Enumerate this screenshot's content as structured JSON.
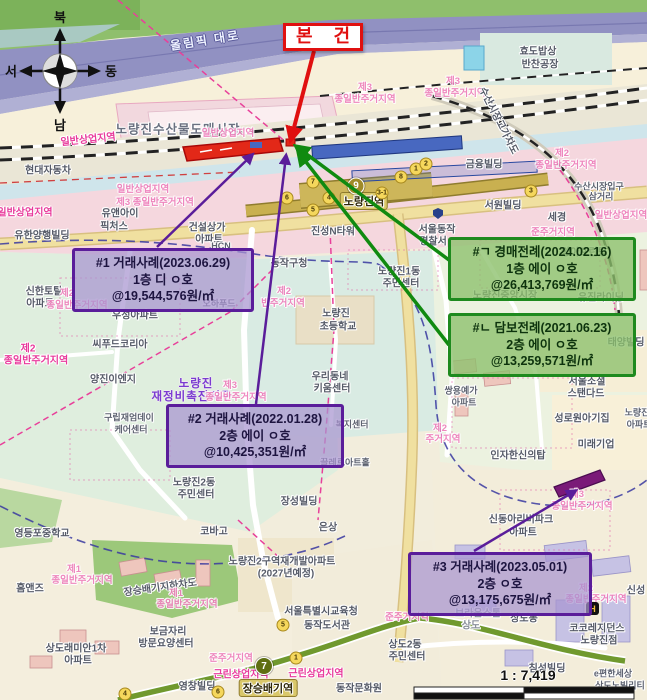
{
  "subject": {
    "label": "본 건"
  },
  "compass": {
    "north": "북",
    "south": "남",
    "east": "동",
    "west": "서"
  },
  "scale": {
    "ratio_text": "1 : 7,419"
  },
  "subway": {
    "line9": {
      "number": "9",
      "station": "노량진역"
    },
    "line7": {
      "number": "7",
      "station": "장승배기역"
    },
    "exits": [
      {
        "n": "6",
        "x": 287,
        "y": 198
      },
      {
        "n": "5",
        "x": 313,
        "y": 210
      },
      {
        "n": "7",
        "x": 313,
        "y": 182
      },
      {
        "n": "4",
        "x": 329,
        "y": 198
      },
      {
        "n": "3-1",
        "x": 382,
        "y": 193
      },
      {
        "n": "8",
        "x": 401,
        "y": 177
      },
      {
        "n": "1",
        "x": 416,
        "y": 169
      },
      {
        "n": "2",
        "x": 426,
        "y": 164
      },
      {
        "n": "3",
        "x": 531,
        "y": 191
      },
      {
        "n": "5",
        "x": 283,
        "y": 625
      },
      {
        "n": "1",
        "x": 296,
        "y": 658
      },
      {
        "n": "6",
        "x": 218,
        "y": 692
      },
      {
        "n": "4",
        "x": 125,
        "y": 694
      }
    ]
  },
  "colors": {
    "transaction_border": "#5a1d9a",
    "precedent_border": "#1e8a1e",
    "subject_red": "#e01010",
    "line9_gold": "#a08a28",
    "line7_olive": "#5f6f12"
  },
  "annotations": {
    "boxes": [
      {
        "type": "transaction",
        "line1": "#1 거래사례(2023.06.29)",
        "line2": "1층 디 ㅇ호",
        "line3": "@19,544,576원/㎡"
      },
      {
        "type": "transaction",
        "line1": "#2 거래사례(2022.01.28)",
        "line2": "2층 에이 ㅇ호",
        "line3": "@10,425,351원/㎡"
      },
      {
        "type": "transaction",
        "line1": "#3 거래사례(2023.05.01)",
        "line2": "2층 ㅇ호",
        "line3": "@13,175,675원/㎡"
      },
      {
        "type": "auction",
        "line1": "#ㄱ 경매전례(2024.02.16)",
        "line2": "1층 에이 ㅇ호",
        "line3": "@26,413,769원/㎡"
      },
      {
        "type": "mortgage",
        "line1": "#ㄴ 담보전례(2021.06.23)",
        "line2": "2층 에이 ㅇ호",
        "line3": "@13,259,571원/㎡"
      }
    ]
  },
  "hotel_icon_label": "H",
  "map_labels": [
    {
      "t": "올림픽 대로",
      "x": 205,
      "y": 40,
      "c": "road",
      "r": -9
    },
    {
      "t": "효도밥상",
      "x": 538,
      "y": 50,
      "c": "g"
    },
    {
      "t": "반찬공장",
      "x": 540,
      "y": 63,
      "c": "g"
    },
    {
      "t": "노량진수산물도매시장",
      "x": 178,
      "y": 128,
      "c": "gbig"
    },
    {
      "t": "일반상업지역",
      "x": 88,
      "y": 138,
      "c": "pink",
      "r": -6
    },
    {
      "t": "일반상업지역",
      "x": 228,
      "y": 132,
      "c": "pinkf"
    },
    {
      "t": "제3",
      "x": 365,
      "y": 86,
      "c": "pinkf"
    },
    {
      "t": "종일반주거지역",
      "x": 365,
      "y": 98,
      "c": "pinkf"
    },
    {
      "t": "제3",
      "x": 453,
      "y": 80,
      "c": "pinkf"
    },
    {
      "t": "종일반주거지역",
      "x": 455,
      "y": 92,
      "c": "pinkf"
    },
    {
      "t": "수산시장고가차도",
      "x": 500,
      "y": 120,
      "c": "g",
      "r": 63
    },
    {
      "t": "금융빌딩",
      "x": 484,
      "y": 163,
      "c": "g"
    },
    {
      "t": "제2",
      "x": 562,
      "y": 152,
      "c": "pinkf"
    },
    {
      "t": "종일반주거지역",
      "x": 566,
      "y": 164,
      "c": "pinkf"
    },
    {
      "t": "현대자동차",
      "x": 48,
      "y": 169,
      "c": "g"
    },
    {
      "t": "일반상업지역",
      "x": 25,
      "y": 211,
      "c": "pink"
    },
    {
      "t": "일반상업지역",
      "x": 143,
      "y": 188,
      "c": "pinkf"
    },
    {
      "t": "제3 종일반주거지역",
      "x": 155,
      "y": 201,
      "c": "pinkf"
    },
    {
      "t": "유앤아이",
      "x": 120,
      "y": 212,
      "c": "g"
    },
    {
      "t": "픽처스",
      "x": 114,
      "y": 225,
      "c": "g"
    },
    {
      "t": "건설상가",
      "x": 207,
      "y": 226,
      "c": "g"
    },
    {
      "t": "아파트",
      "x": 209,
      "y": 238,
      "c": "g"
    },
    {
      "t": "유한양행빌딩",
      "x": 42,
      "y": 234,
      "c": "g"
    },
    {
      "t": "HCN",
      "x": 221,
      "y": 246,
      "c": "gsm"
    },
    {
      "t": "수산시장입구",
      "x": 599,
      "y": 186,
      "c": "gsm"
    },
    {
      "t": "삼거리",
      "x": 601,
      "y": 196,
      "c": "gsm"
    },
    {
      "t": "일반상업지역",
      "x": 621,
      "y": 214,
      "c": "pinkf"
    },
    {
      "t": "서원빌딩",
      "x": 503,
      "y": 204,
      "c": "g"
    },
    {
      "t": "세경",
      "x": 557,
      "y": 216,
      "c": "g"
    },
    {
      "t": "노량진역",
      "x": 364,
      "y": 201,
      "c": "st"
    },
    {
      "t": "진성N타워",
      "x": 333,
      "y": 230,
      "c": "g"
    },
    {
      "t": "서울동작",
      "x": 437,
      "y": 228,
      "c": "g"
    },
    {
      "t": "경찰서",
      "x": 433,
      "y": 240,
      "c": "g"
    },
    {
      "t": "동작구청",
      "x": 289,
      "y": 262,
      "c": "g"
    },
    {
      "t": "노량진1동",
      "x": 399,
      "y": 270,
      "c": "g"
    },
    {
      "t": "주민센터",
      "x": 401,
      "y": 282,
      "c": "g"
    },
    {
      "t": "노량진",
      "x": 336,
      "y": 312,
      "c": "g"
    },
    {
      "t": "초등학교",
      "x": 338,
      "y": 325,
      "c": "g"
    },
    {
      "t": "제2",
      "x": 284,
      "y": 290,
      "c": "pinkf"
    },
    {
      "t": "반주거지역",
      "x": 283,
      "y": 302,
      "c": "pinkf"
    },
    {
      "t": "준주거지역",
      "x": 553,
      "y": 231,
      "c": "pinkf"
    },
    {
      "t": "양아프린팅",
      "x": 584,
      "y": 251,
      "c": "g"
    },
    {
      "t": "노량진중앙시장",
      "x": 505,
      "y": 294,
      "c": "g"
    },
    {
      "t": "유진라이닝",
      "x": 601,
      "y": 296,
      "c": "g"
    },
    {
      "t": "태양빌딩",
      "x": 626,
      "y": 341,
      "c": "g"
    },
    {
      "t": "서울소셜",
      "x": 587,
      "y": 380,
      "c": "g"
    },
    {
      "t": "스탠다드",
      "x": 586,
      "y": 392,
      "c": "g"
    },
    {
      "t": "성로원아기집",
      "x": 582,
      "y": 417,
      "c": "g"
    },
    {
      "t": "미래기업",
      "x": 596,
      "y": 443,
      "c": "g"
    },
    {
      "t": "인자한신의탑",
      "x": 518,
      "y": 454,
      "c": "g"
    },
    {
      "t": "쌍용예가",
      "x": 461,
      "y": 390,
      "c": "gsm"
    },
    {
      "t": "아파트",
      "x": 464,
      "y": 402,
      "c": "gsm"
    },
    {
      "t": "제2",
      "x": 440,
      "y": 427,
      "c": "pinkf"
    },
    {
      "t": "주거지역",
      "x": 443,
      "y": 438,
      "c": "pinkf"
    },
    {
      "t": "노량진",
      "x": 637,
      "y": 412,
      "c": "gsm"
    },
    {
      "t": "아파트",
      "x": 639,
      "y": 424,
      "c": "gsm"
    },
    {
      "t": "우리동네",
      "x": 330,
      "y": 375,
      "c": "g"
    },
    {
      "t": "키움센터",
      "x": 332,
      "y": 387,
      "c": "g"
    },
    {
      "t": "복지센터",
      "x": 352,
      "y": 424,
      "c": "gsm"
    },
    {
      "t": "끌레르아트홀",
      "x": 345,
      "y": 462,
      "c": "gsm"
    },
    {
      "t": "노량진",
      "x": 196,
      "y": 383,
      "c": "ppl"
    },
    {
      "t": "재정비촉진지구",
      "x": 192,
      "y": 396,
      "c": "ppl"
    },
    {
      "t": "제3",
      "x": 230,
      "y": 384,
      "c": "pinkf"
    },
    {
      "t": "종일반주거지역",
      "x": 236,
      "y": 396,
      "c": "pinkf"
    },
    {
      "t": "신한토탈",
      "x": 44,
      "y": 290,
      "c": "g"
    },
    {
      "t": "아파트",
      "x": 40,
      "y": 302,
      "c": "g"
    },
    {
      "t": "제2",
      "x": 67,
      "y": 292,
      "c": "pinkf"
    },
    {
      "t": "종일반주거지역",
      "x": 77,
      "y": 304,
      "c": "pinkf"
    },
    {
      "t": "제2",
      "x": 28,
      "y": 347,
      "c": "pink"
    },
    {
      "t": "종일반주거지역",
      "x": 36,
      "y": 359,
      "c": "pink"
    },
    {
      "t": "우성아파트",
      "x": 135,
      "y": 314,
      "c": "g"
    },
    {
      "t": "오하푸드",
      "x": 219,
      "y": 303,
      "c": "gsm"
    },
    {
      "t": "씨푸드코리아",
      "x": 120,
      "y": 343,
      "c": "g"
    },
    {
      "t": "양진이엔지",
      "x": 113,
      "y": 378,
      "c": "g"
    },
    {
      "t": "구립재엄데이",
      "x": 129,
      "y": 417,
      "c": "gsm"
    },
    {
      "t": "케어센터",
      "x": 131,
      "y": 429,
      "c": "gsm"
    },
    {
      "t": "노량진2동",
      "x": 194,
      "y": 481,
      "c": "g"
    },
    {
      "t": "주민센터",
      "x": 196,
      "y": 493,
      "c": "g"
    },
    {
      "t": "장성빌딩",
      "x": 299,
      "y": 500,
      "c": "g"
    },
    {
      "t": "코바고",
      "x": 214,
      "y": 530,
      "c": "g"
    },
    {
      "t": "은상",
      "x": 328,
      "y": 526,
      "c": "g"
    },
    {
      "t": "영등포중학교",
      "x": 42,
      "y": 532,
      "c": "g"
    },
    {
      "t": "홈앤즈",
      "x": 30,
      "y": 587,
      "c": "g"
    },
    {
      "t": "노량진2구역재개발아파트",
      "x": 282,
      "y": 560,
      "c": "g"
    },
    {
      "t": "(2027년예정)",
      "x": 286,
      "y": 572,
      "c": "g"
    },
    {
      "t": "장승배기지하차도",
      "x": 160,
      "y": 586,
      "c": "g",
      "r": -8
    },
    {
      "t": "제1",
      "x": 74,
      "y": 568,
      "c": "pinkf"
    },
    {
      "t": "종일반주거지역",
      "x": 82,
      "y": 579,
      "c": "pinkf"
    },
    {
      "t": "제1",
      "x": 176,
      "y": 592,
      "c": "pinkf"
    },
    {
      "t": "종일반주거지역",
      "x": 187,
      "y": 603,
      "c": "pinkf"
    },
    {
      "t": "보금자리",
      "x": 168,
      "y": 630,
      "c": "g"
    },
    {
      "t": "방문요양센터",
      "x": 166,
      "y": 642,
      "c": "g"
    },
    {
      "t": "상도래미안1차",
      "x": 76,
      "y": 647,
      "c": "g"
    },
    {
      "t": "아파트",
      "x": 78,
      "y": 659,
      "c": "g"
    },
    {
      "t": "준주거지역",
      "x": 231,
      "y": 657,
      "c": "pinkf"
    },
    {
      "t": "근린상업지역",
      "x": 241,
      "y": 673,
      "c": "pink"
    },
    {
      "t": "근린상업지역",
      "x": 316,
      "y": 672,
      "c": "pink"
    },
    {
      "t": "영창빌딩",
      "x": 197,
      "y": 685,
      "c": "g"
    },
    {
      "t": "장승배기역",
      "x": 268,
      "y": 688,
      "c": "st"
    },
    {
      "t": "서울특별시교육청",
      "x": 321,
      "y": 610,
      "c": "g"
    },
    {
      "t": "동작도서관",
      "x": 327,
      "y": 624,
      "c": "g"
    },
    {
      "t": "준주거지역",
      "x": 407,
      "y": 616,
      "c": "pinkf"
    },
    {
      "t": "동작문화원",
      "x": 359,
      "y": 687,
      "c": "g"
    },
    {
      "t": "상도2동",
      "x": 405,
      "y": 643,
      "c": "g"
    },
    {
      "t": "주민센터",
      "x": 407,
      "y": 655,
      "c": "g"
    },
    {
      "t": "브라운스톤",
      "x": 478,
      "y": 612,
      "c": "gfad"
    },
    {
      "t": "상도",
      "x": 471,
      "y": 624,
      "c": "gfad"
    },
    {
      "t": "상도동",
      "x": 524,
      "y": 617,
      "c": "g"
    },
    {
      "t": "코코레지던스",
      "x": 597,
      "y": 627,
      "c": "g"
    },
    {
      "t": "노량진점",
      "x": 599,
      "y": 639,
      "c": "g"
    },
    {
      "t": "침성빌딩",
      "x": 547,
      "y": 667,
      "c": "g"
    },
    {
      "t": "e편한세상",
      "x": 613,
      "y": 673,
      "c": "gsm"
    },
    {
      "t": "상도노빌리티",
      "x": 620,
      "y": 685,
      "c": "gsm"
    },
    {
      "t": "신동아리버파크",
      "x": 521,
      "y": 518,
      "c": "g"
    },
    {
      "t": "아파트",
      "x": 523,
      "y": 531,
      "c": "g"
    },
    {
      "t": "제3",
      "x": 577,
      "y": 493,
      "c": "pinkf"
    },
    {
      "t": "종일반주거지역",
      "x": 582,
      "y": 505,
      "c": "pinkf"
    },
    {
      "t": "제2",
      "x": 586,
      "y": 587,
      "c": "pinkf"
    },
    {
      "t": "종일반주거지역",
      "x": 596,
      "y": 598,
      "c": "pinkf"
    },
    {
      "t": "신성",
      "x": 636,
      "y": 589,
      "c": "g"
    }
  ]
}
